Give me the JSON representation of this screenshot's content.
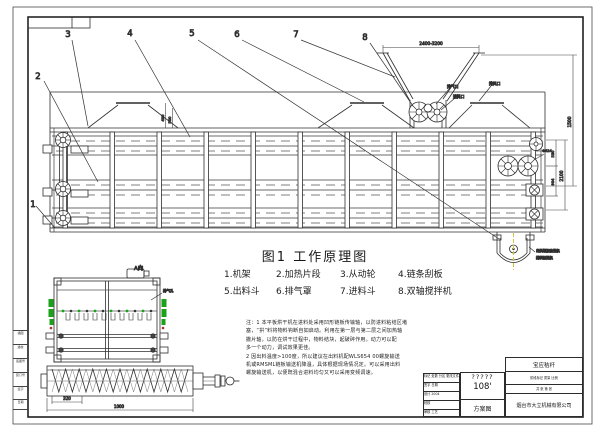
{
  "figure": {
    "title": "图1  工作原理图",
    "legend": [
      "1.机架",
      "2.加热片段",
      "3.从动轮",
      "4.链条刮板",
      "5.出料斗",
      "6.排气罩",
      "7.进料斗",
      "8.双轴搅拌机"
    ],
    "callouts": [
      "1",
      "2",
      "3",
      "4",
      "5",
      "6",
      "7",
      "8"
    ],
    "view_a_label": "A向"
  },
  "labels": {
    "exhaust_port": "排气口",
    "feed_port": "进料口",
    "vent_port": "排风口",
    "vent_hole": "排气孔",
    "discharge_line1": "出料螺旋输送机",
    "discharge_line2": "排料输送机"
  },
  "dims": {
    "hopper_span": "2400-3200",
    "right_outer": "1500",
    "right_mid": "2100",
    "right_inner_top": "530",
    "right_inner_bot": "904",
    "wheel_dia": "Φ624",
    "hood_a": "400",
    "hood_b": "500",
    "auger_pitch": "320",
    "auger_len": "1000"
  },
  "notes": {
    "lines": [
      "注：1 本平板烘干机在进料处采用凹形链板传输轴，以防进料粘结区堵",
      "塞，“拱”料将物料钩断自如启动。利用在第一层与第二层之间加热轴",
      "撒片轴，以防在烘干过程中，物料结块，起破碎作用。动力可以配",
      "多一个动力，调试效果更佳。",
      "2 因出料温度>100度，所以建议在出料机配WLS654 00螺旋输送",
      "机或RMSML链板输送机降温，具体根据现场情况定。可以采用出料",
      "螺旋输送机，以便既混合进料均匀又可以采用变频调速。"
    ]
  },
  "titleblock": {
    "drawing_no_masked": "?????",
    "drawing_no": "108'",
    "doc_type": "方案图",
    "project": "宝应秸秆",
    "company": "烟台市大立机械有限公司",
    "cells_row": "阶段标记  质量  比例",
    "sheet_row": "共 张  第 张",
    "left_rows": [
      "标记 处数 分区 更改文件号",
      "签字 日期",
      "设计 2004",
      "校核",
      "审核 工艺"
    ]
  },
  "border_strip": [
    "描图",
    "描校",
    "底图号",
    "装订号",
    "签字",
    "日期"
  ],
  "colors": {
    "accent_green": "#1aa21a",
    "accent_yellow": "#c9c93a",
    "line": "#2e2e2e"
  }
}
